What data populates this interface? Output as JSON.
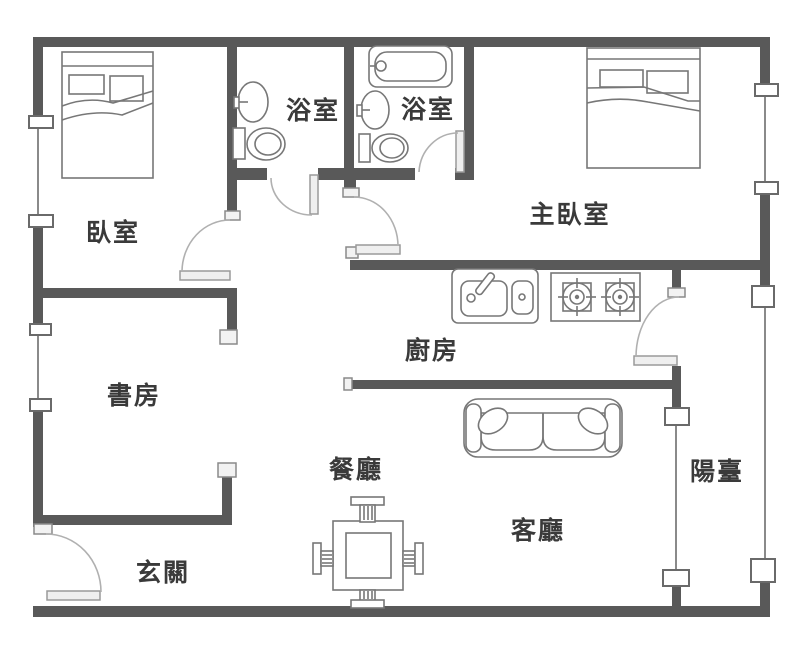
{
  "figure": {
    "type": "floor-plan"
  },
  "rooms": [
    {
      "id": "bedroom",
      "label": "臥室"
    },
    {
      "id": "bathroom-1",
      "label": "浴室"
    },
    {
      "id": "bathroom-2",
      "label": "浴室"
    },
    {
      "id": "master-bedroom",
      "label": "主臥室"
    },
    {
      "id": "kitchen",
      "label": "廚房"
    },
    {
      "id": "study",
      "label": "書房"
    },
    {
      "id": "dining-room",
      "label": "餐廳"
    },
    {
      "id": "living-room",
      "label": "客廳"
    },
    {
      "id": "entrance",
      "label": "玄關"
    },
    {
      "id": "balcony",
      "label": "陽臺"
    }
  ],
  "colors": {
    "wall": "#595959",
    "furniture_outline": "#777777",
    "door_arc": "#b0b0b0",
    "label_text": "#3a3a3a",
    "background": "#ffffff",
    "window_line": "#8a8a8a"
  }
}
